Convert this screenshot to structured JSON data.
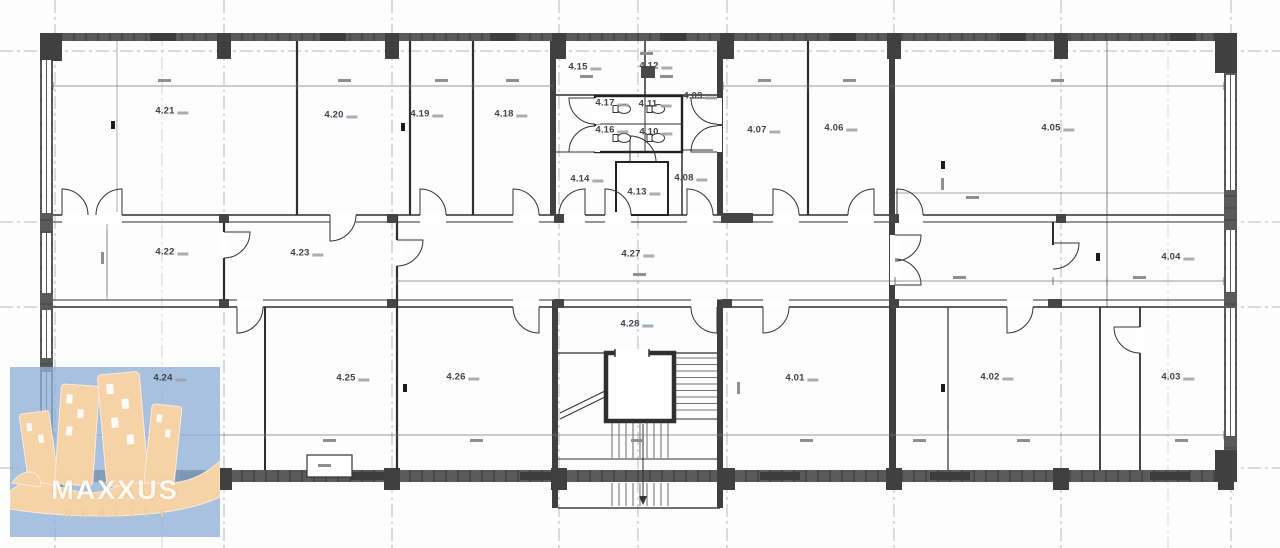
{
  "branding": {
    "logo_title": "MAXXUS",
    "logo_subtitle": "REALITY"
  },
  "floor_plan": {
    "floor_prefix": "4",
    "rooms": [
      {
        "id": "4.21",
        "x": 172,
        "y": 111
      },
      {
        "id": "4.20",
        "x": 341,
        "y": 115
      },
      {
        "id": "4.19",
        "x": 427,
        "y": 114
      },
      {
        "id": "4.18",
        "x": 511,
        "y": 114
      },
      {
        "id": "4.15",
        "x": 585,
        "y": 67
      },
      {
        "id": "4.12",
        "x": 656,
        "y": 66
      },
      {
        "id": "4.17",
        "x": 612,
        "y": 103
      },
      {
        "id": "4.11",
        "x": 655,
        "y": 104
      },
      {
        "id": "4.16",
        "x": 612,
        "y": 130
      },
      {
        "id": "4.10",
        "x": 656,
        "y": 132
      },
      {
        "id": "4.09",
        "x": 700,
        "y": 96
      },
      {
        "id": "4.14",
        "x": 587,
        "y": 179
      },
      {
        "id": "4.13",
        "x": 644,
        "y": 192
      },
      {
        "id": "4.08",
        "x": 691,
        "y": 178
      },
      {
        "id": "4.07",
        "x": 764,
        "y": 130
      },
      {
        "id": "4.06",
        "x": 841,
        "y": 128
      },
      {
        "id": "4.05",
        "x": 1058,
        "y": 128
      },
      {
        "id": "4.22",
        "x": 172,
        "y": 252
      },
      {
        "id": "4.23",
        "x": 307,
        "y": 253
      },
      {
        "id": "4.27",
        "x": 638,
        "y": 254
      },
      {
        "id": "4.04",
        "x": 1178,
        "y": 257
      },
      {
        "id": "4.28",
        "x": 637,
        "y": 324
      },
      {
        "id": "4.24",
        "x": 170,
        "y": 378
      },
      {
        "id": "4.25",
        "x": 353,
        "y": 378
      },
      {
        "id": "4.26",
        "x": 463,
        "y": 377
      },
      {
        "id": "4.01",
        "x": 802,
        "y": 378
      },
      {
        "id": "4.02",
        "x": 997,
        "y": 377
      },
      {
        "id": "4.03",
        "x": 1178,
        "y": 377
      }
    ]
  },
  "colors": {
    "outer_wall": "#5a5a5a",
    "column": "#404040",
    "interior_line": "#2f2f2f",
    "axis_line": "#b5b9bd",
    "dimension": "#8f8f8f",
    "logo_background": "#8eafd5",
    "logo_accent": "#f6d3a7",
    "logo_title_color": "#fdfaf3",
    "logo_subtitle_color": "#f2c9a1"
  }
}
